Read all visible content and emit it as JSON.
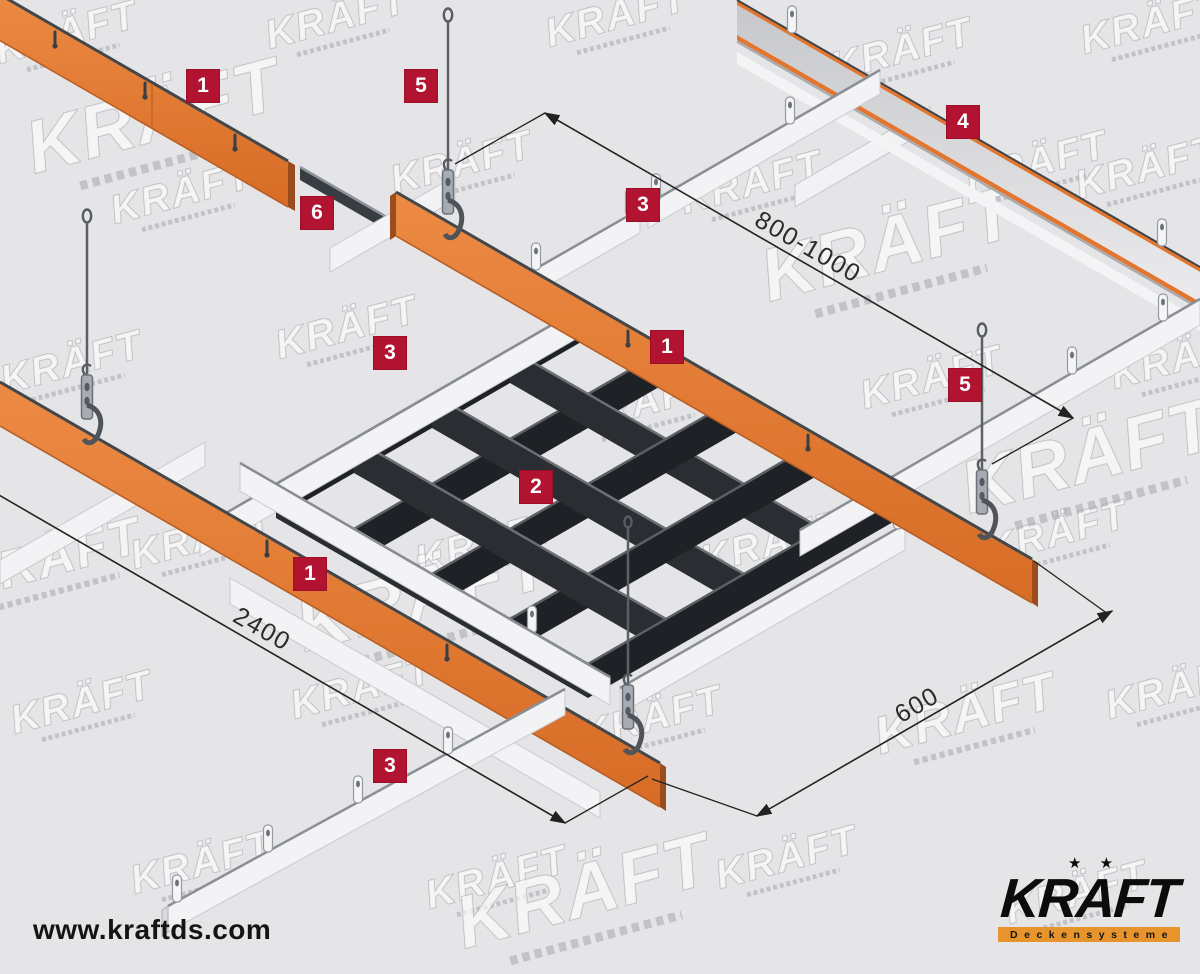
{
  "diagram": {
    "watermark": {
      "text": "KRÄFT"
    },
    "callouts": [
      {
        "label": "1"
      },
      {
        "label": "5"
      },
      {
        "label": "6"
      },
      {
        "label": "3"
      },
      {
        "label": "4"
      },
      {
        "label": "3"
      },
      {
        "label": "1"
      },
      {
        "label": "5"
      },
      {
        "label": "2"
      },
      {
        "label": "1"
      },
      {
        "label": "3"
      }
    ],
    "dimensions": [
      {
        "label": "800-1000"
      },
      {
        "label": "2400"
      },
      {
        "label": "600"
      }
    ],
    "colors": {
      "background": "#e5e5e7",
      "badge_red": "#b11331",
      "rail_orange": "#e2762e",
      "rail_white": "#f3f3f5",
      "grid_dark": "#26292c",
      "metal_gray": "#a6acb2",
      "dimension_line": "#222222",
      "logo_bar_orange": "#e8942c"
    }
  },
  "footer": {
    "website": "www.kraftds.com"
  },
  "logo": {
    "brand": "KRAFT",
    "stars": "★ ★",
    "tagline": "Deckensysteme"
  }
}
